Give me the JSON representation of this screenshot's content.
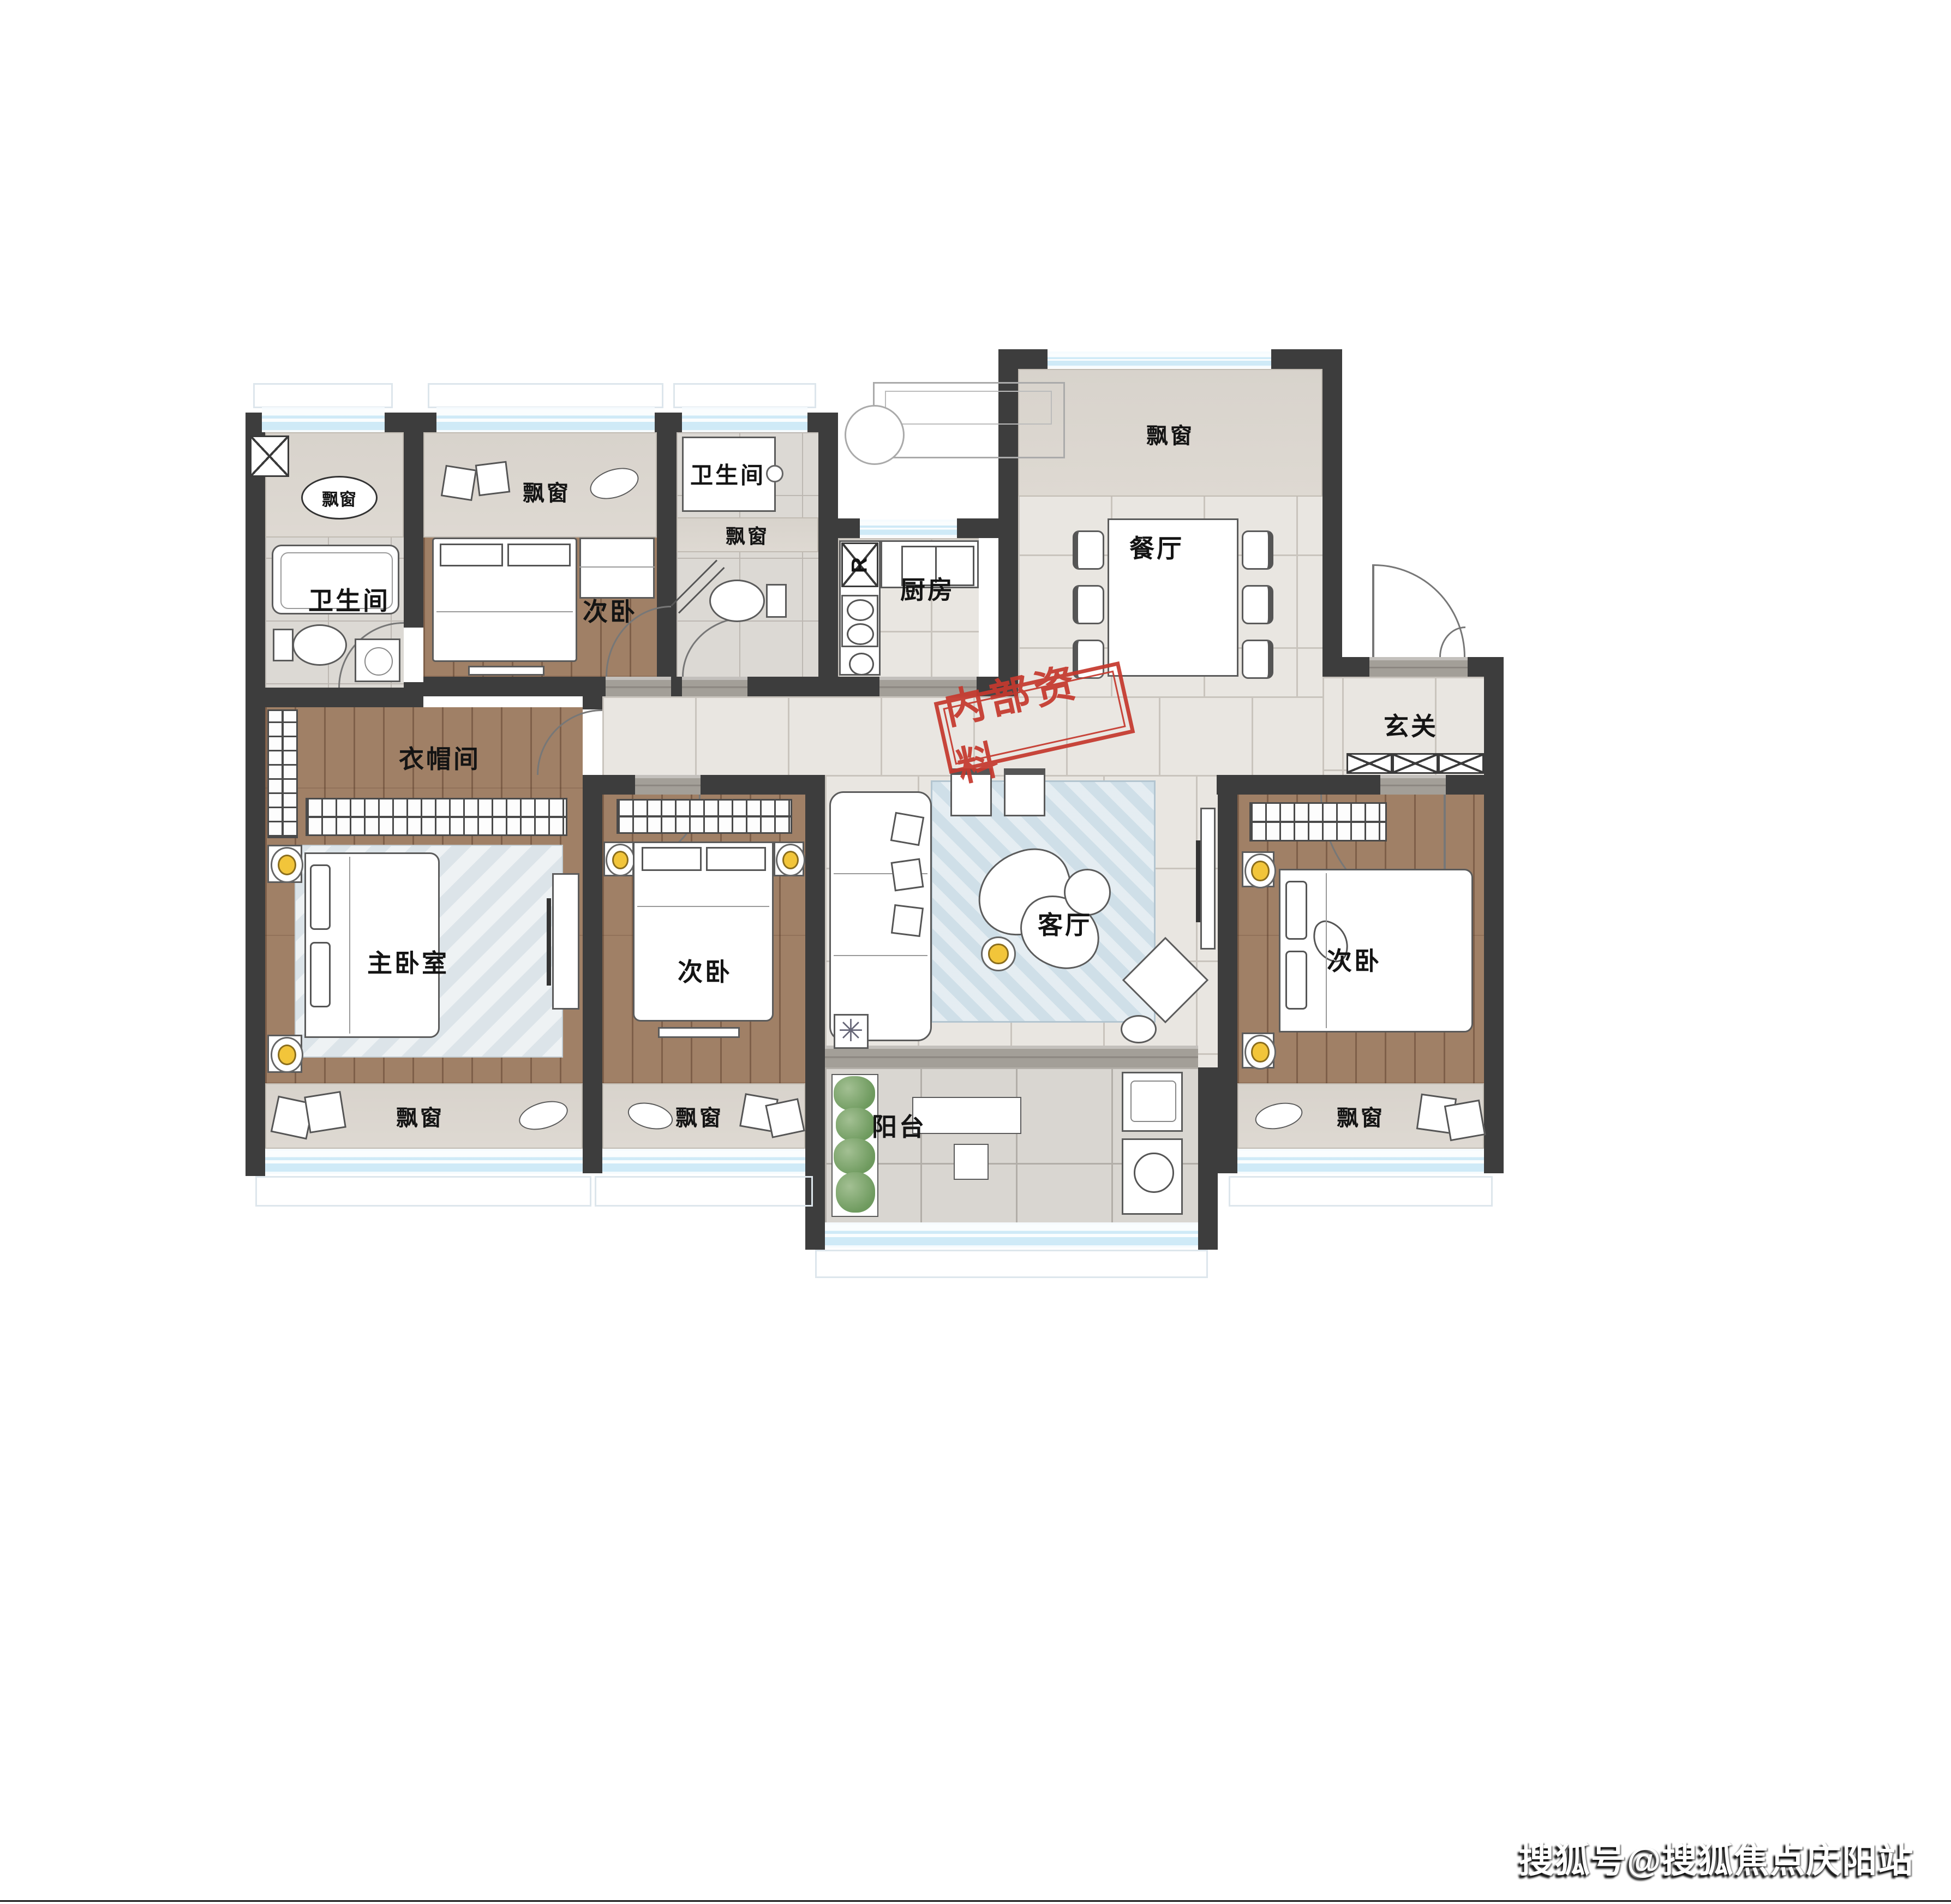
{
  "page": {
    "background": "#ffffff"
  },
  "labels": {
    "bay_window": "飘窗"
  },
  "rooms": {
    "bathroom_top_left": {
      "label": "卫生间"
    },
    "bedroom_top": {
      "label": "次卧"
    },
    "bathroom_mid": {
      "label": "卫生间"
    },
    "kitchen": {
      "label": "厨房",
      "fridge_letter": "R"
    },
    "dining": {
      "label": "餐厅"
    },
    "entry": {
      "label": "玄关"
    },
    "cloakroom": {
      "label": "衣帽间"
    },
    "master": {
      "label": "主卧室"
    },
    "bedroom_mid": {
      "label": "次卧"
    },
    "living": {
      "label": "客厅"
    },
    "bedroom_right": {
      "label": "次卧"
    },
    "balcony": {
      "label": "阳台"
    }
  },
  "stamp": {
    "text": "内部资料",
    "color": "#c5392e"
  },
  "watermark": {
    "text": "搜狐号@搜狐焦点庆阳站"
  },
  "colors": {
    "wall": "#3d3d3d",
    "wood_floor": "#a08066",
    "tile_floor": "#e9e6e1",
    "bath_tile": "#dcd9d4",
    "bay_marble": "#d8d3cc",
    "window_glass": "#cfeaf7",
    "living_rug": "#cfdfe8",
    "stamp_red": "#c5392e",
    "lamp_yellow": "#f2c53a",
    "plant_green": "#6e9a5e"
  }
}
